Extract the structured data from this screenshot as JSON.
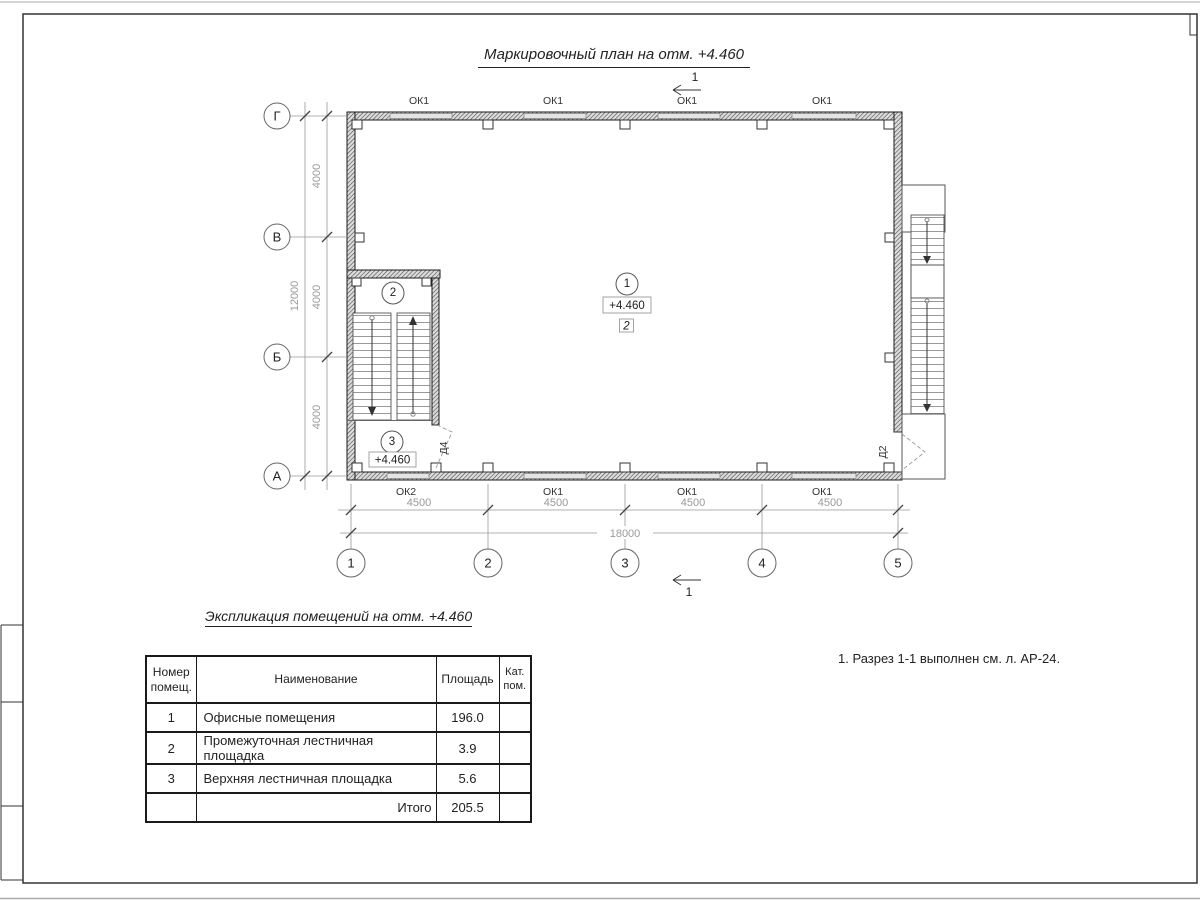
{
  "page": {
    "plan_title": "Маркировочный план на отм. +4.460",
    "schedule_title": "Экспликация помещений на отм. +4.460",
    "note": "1. Разрез 1-1 выполнен см. л. АР-24."
  },
  "plan": {
    "section_label": "1",
    "grid_rows": [
      "Г",
      "В",
      "Б",
      "А"
    ],
    "grid_cols": [
      "1",
      "2",
      "3",
      "4",
      "5"
    ],
    "dim_v_segments": [
      "4000",
      "4000",
      "4000"
    ],
    "dim_v_total": "12000",
    "dim_h_segments": [
      "4500",
      "4500",
      "4500",
      "4500"
    ],
    "dim_h_total": "18000",
    "windows_top": [
      "ОК1",
      "ОК1",
      "ОК1",
      "ОК1"
    ],
    "windows_bottom": [
      "ОК2",
      "ОК1",
      "ОК1",
      "ОК1"
    ],
    "door_stair": "Д4",
    "door_exit": "Д2",
    "room1": {
      "num": "1",
      "elev": "+4.460",
      "finish": "2"
    },
    "room2": {
      "num": "2"
    },
    "room3": {
      "num": "3",
      "elev": "+4.460"
    }
  },
  "schedule": {
    "col_num": "Номер помещ.",
    "col_name": "Наименование",
    "col_area": "Площадь",
    "col_cat": "Кат. пом.",
    "rows": [
      {
        "num": "1",
        "name": "Офисные помещения",
        "area": "196.0",
        "cat": ""
      },
      {
        "num": "2",
        "name": "Промежуточная лестничная площадка",
        "area": "3.9",
        "cat": ""
      },
      {
        "num": "3",
        "name": "Верхняя лестничная площадка",
        "area": "5.6",
        "cat": ""
      }
    ],
    "total_label": "Итого",
    "total_value": "205.5"
  }
}
